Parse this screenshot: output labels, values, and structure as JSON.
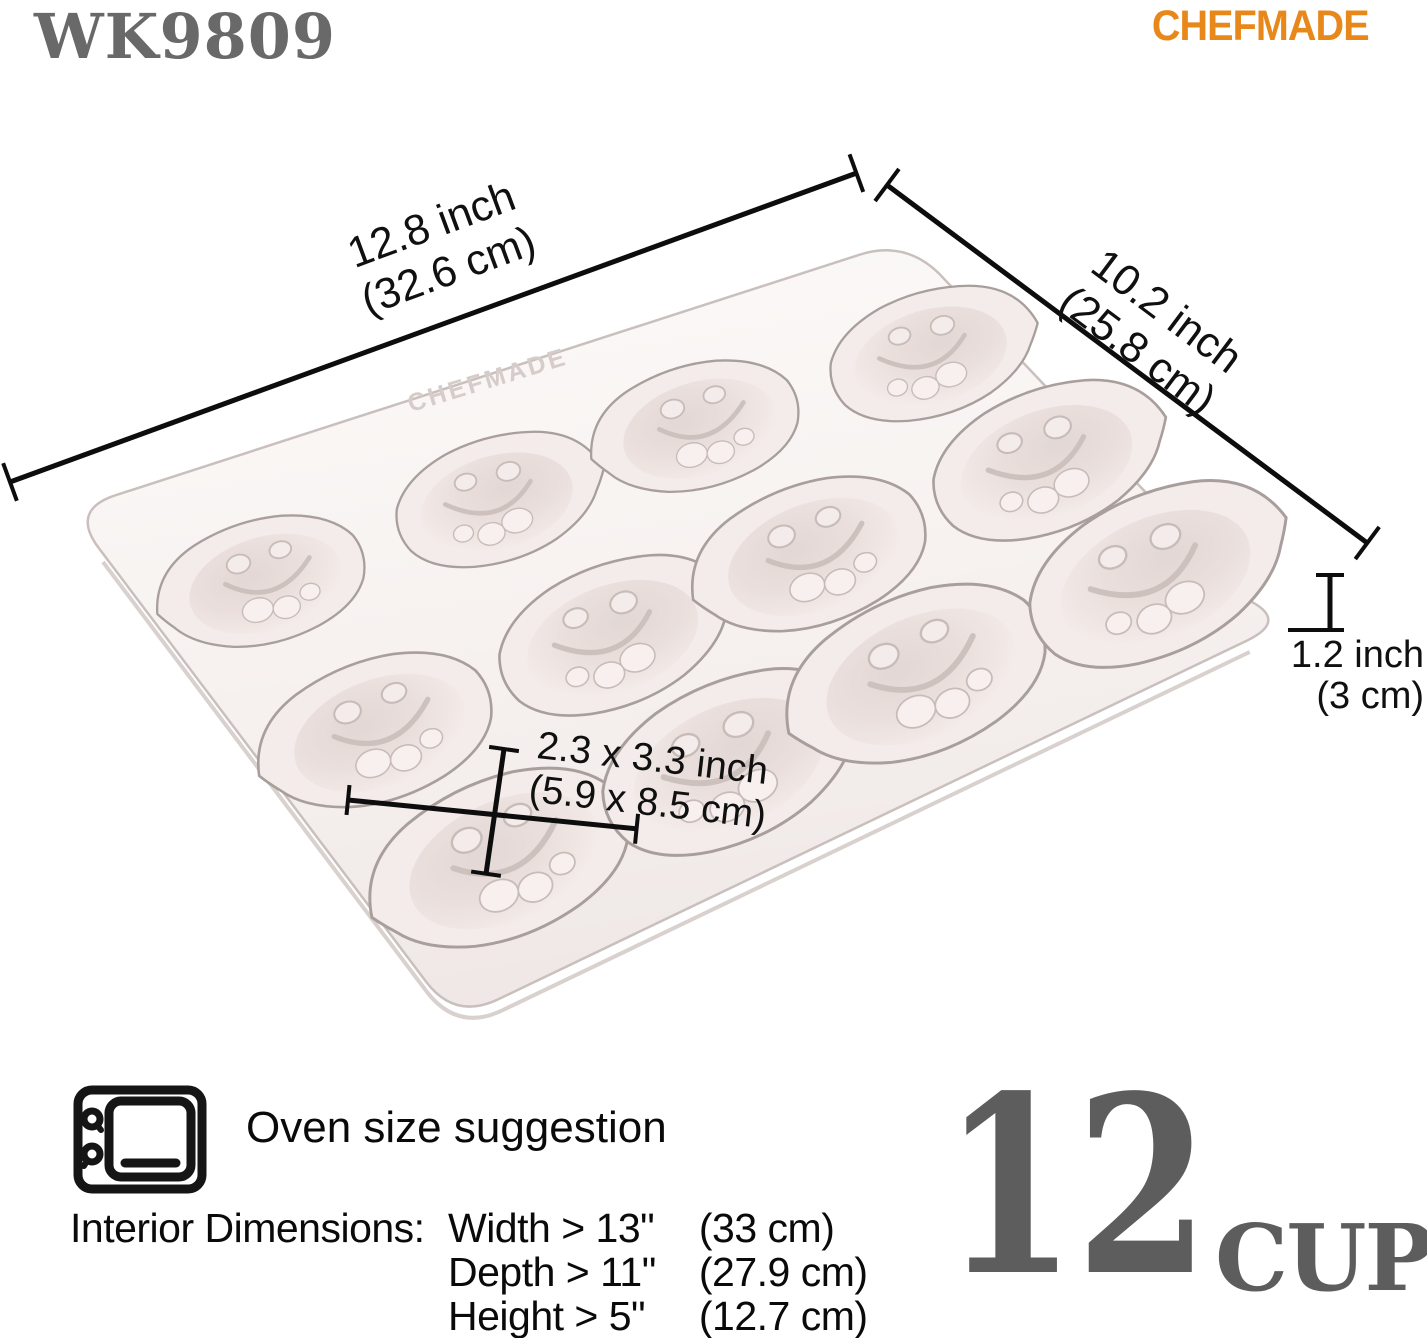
{
  "header": {
    "model_number": "WK9809",
    "brand": "CHEFMADE"
  },
  "colors": {
    "brand_orange": "#E8881B",
    "model_gray": "#696969",
    "capacity_gray": "#5D5D5D",
    "annotation_black": "#101010",
    "pan_body": "#F6F0EE",
    "pan_outline": "#C9C0BD"
  },
  "pan": {
    "embossed_brand": "CHEFMADE",
    "cup_count": 12,
    "cup_shape": "lemon"
  },
  "dimensions": {
    "length": {
      "inches": "12.8 inch",
      "metric": "(32.6 cm)"
    },
    "depth": {
      "inches": "10.2 inch",
      "metric": "(25.8 cm)"
    },
    "height": {
      "inches": "1.2 inch",
      "metric": "(3 cm)"
    },
    "cup_size": {
      "inches": "2.3 x 3.3 inch",
      "metric": "(5.9 x 8.5 cm)"
    }
  },
  "oven_suggestion": {
    "title": "Oven size suggestion",
    "interior_label": "Interior Dimensions:",
    "rows": [
      {
        "dimension": "Width > 13\"",
        "metric": "(33 cm)"
      },
      {
        "dimension": "Depth > 11\"",
        "metric": "(27.9 cm)"
      },
      {
        "dimension": "Height > 5\"",
        "metric": "(12.7 cm)"
      }
    ]
  },
  "capacity": {
    "count": "12",
    "unit": "CUP"
  }
}
